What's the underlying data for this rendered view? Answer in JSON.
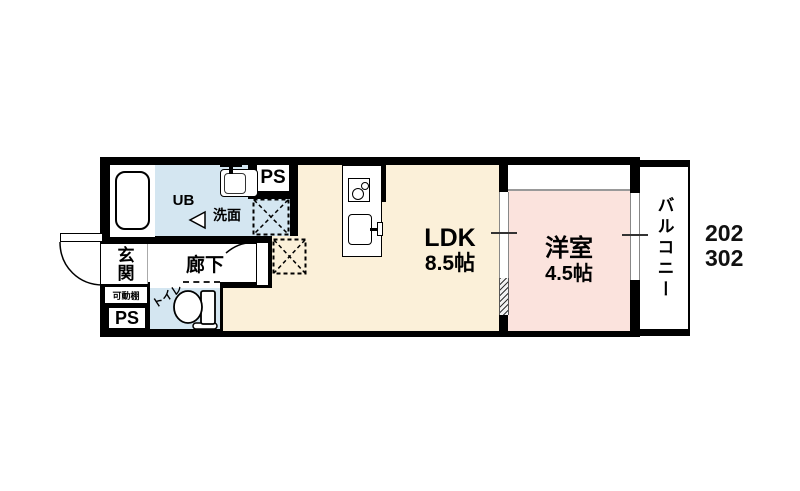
{
  "floorplan": {
    "unit_numbers": {
      "line1": "202",
      "line2": "302"
    },
    "rooms": {
      "ldk": {
        "label": "LDK",
        "size": "8.5帖"
      },
      "western_room": {
        "label": "洋室",
        "size": "4.5帖"
      },
      "balcony": {
        "label": "バルコニー"
      },
      "entrance": {
        "label": "玄関"
      },
      "hallway": {
        "label": "廊下"
      },
      "toilet": {
        "label": "トイレ"
      },
      "unit_bath": {
        "label": "UB"
      },
      "washroom": {
        "label": "洗面"
      },
      "pipe_space_top": {
        "label": "PS"
      },
      "pipe_space_bottom": {
        "label": "PS"
      },
      "movable_shelf": {
        "label": "可動棚"
      }
    },
    "fixture_icons": [
      "bathtub-icon",
      "washbasin-icon",
      "toilet-icon",
      "stove-icon",
      "sink-icon",
      "washing-machine-space-icon",
      "refrigerator-space-icon",
      "entrance-door-swing-icon",
      "hall-door-swing-icon",
      "sliding-door-icon",
      "window-icon",
      "unit-bath-door-icon"
    ],
    "colors": {
      "wall": "#000000",
      "ldk_floor": "#FBF0D9",
      "western_room_floor": "#FBE3DD",
      "wet_area_floor": "#D4E6F1",
      "background": "#FFFFFF"
    }
  }
}
